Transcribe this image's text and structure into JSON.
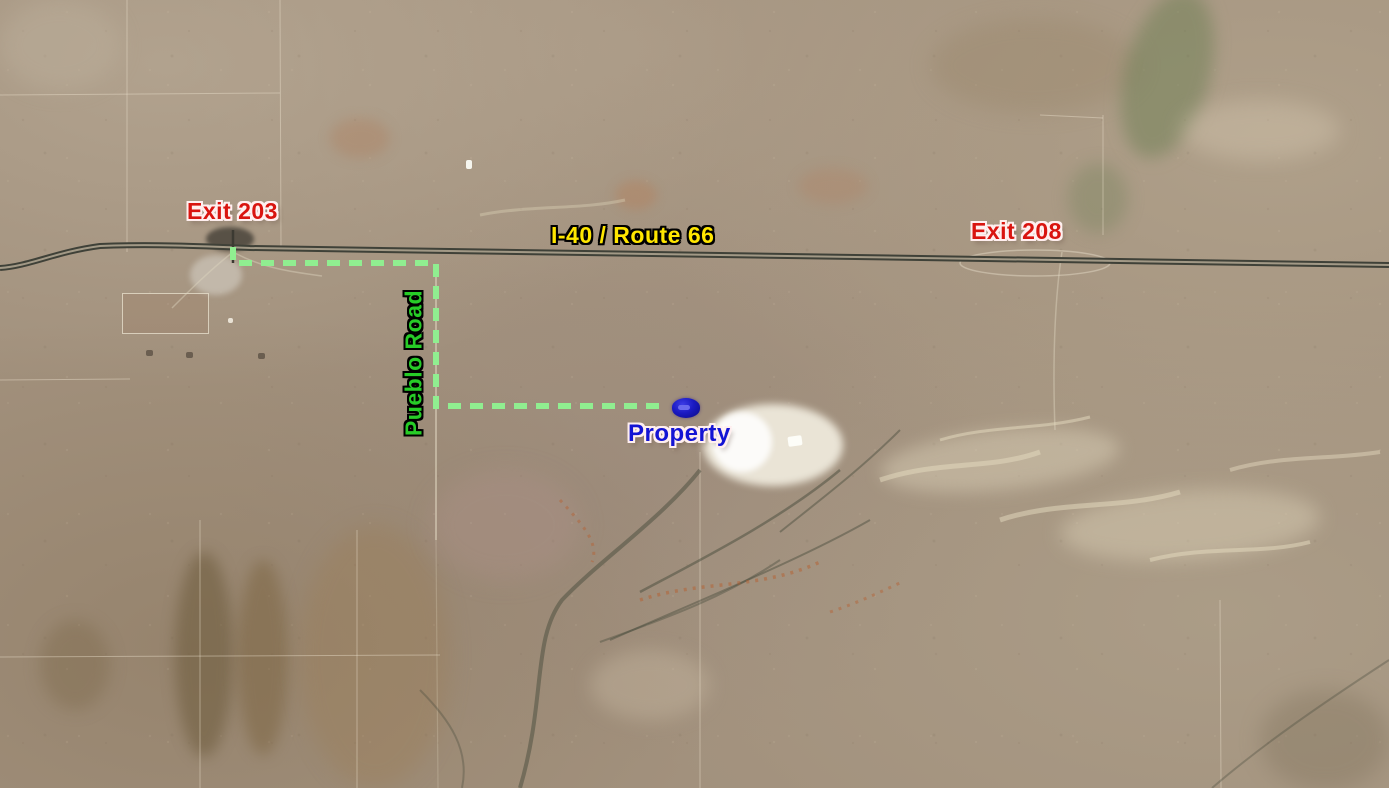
{
  "map": {
    "labels": {
      "exit_203": "Exit 203",
      "highway": "I-40 / Route 66",
      "exit_208": "Exit 208",
      "road": "Pueblo Road",
      "property": "Property"
    },
    "colors": {
      "exit_label": "#d9140f",
      "highway_label": "#ffe600",
      "road_label": "#27cc27",
      "property_label": "#1414d4",
      "route_line": "#90ee90",
      "marker": "#1515b8"
    },
    "route": {
      "style": "dashed"
    }
  }
}
